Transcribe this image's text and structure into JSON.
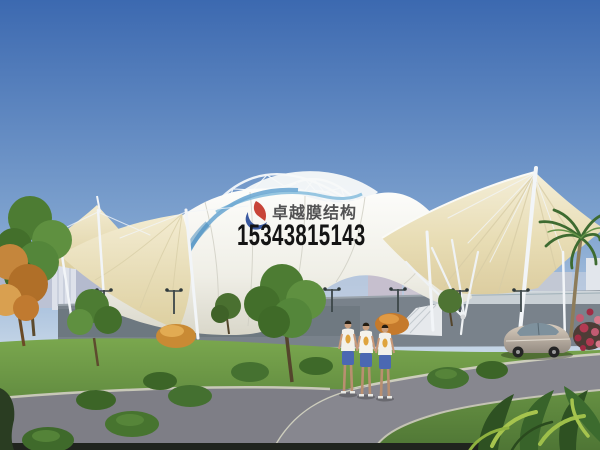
{
  "watermark": {
    "brand": "卓越膜结构",
    "phone": "15343815143"
  },
  "scene": {
    "palette": {
      "sky_top": "#3c69b0",
      "sky_horizon": "#dce6f0",
      "membrane_white": "#f4f3ec",
      "membrane_cream": "#e8ddb6",
      "membrane_trim_blue": "#6fa9d3",
      "steel_white": "#eef3f8",
      "grass_green": "#6f9a45",
      "foliage_green": "#4a7530",
      "autumn_orange": "#c5863c",
      "road_gray": "#84848c",
      "wall_gray": "#79828b",
      "building_haze": "#c6cbda",
      "flower_red": "#b23a52",
      "car_beige": "#c9bdae",
      "watermark_text": "#3b3b3d",
      "watermark_phone": "#141414",
      "logo_red": "#c43528",
      "logo_blue": "#2c4d9a"
    }
  }
}
